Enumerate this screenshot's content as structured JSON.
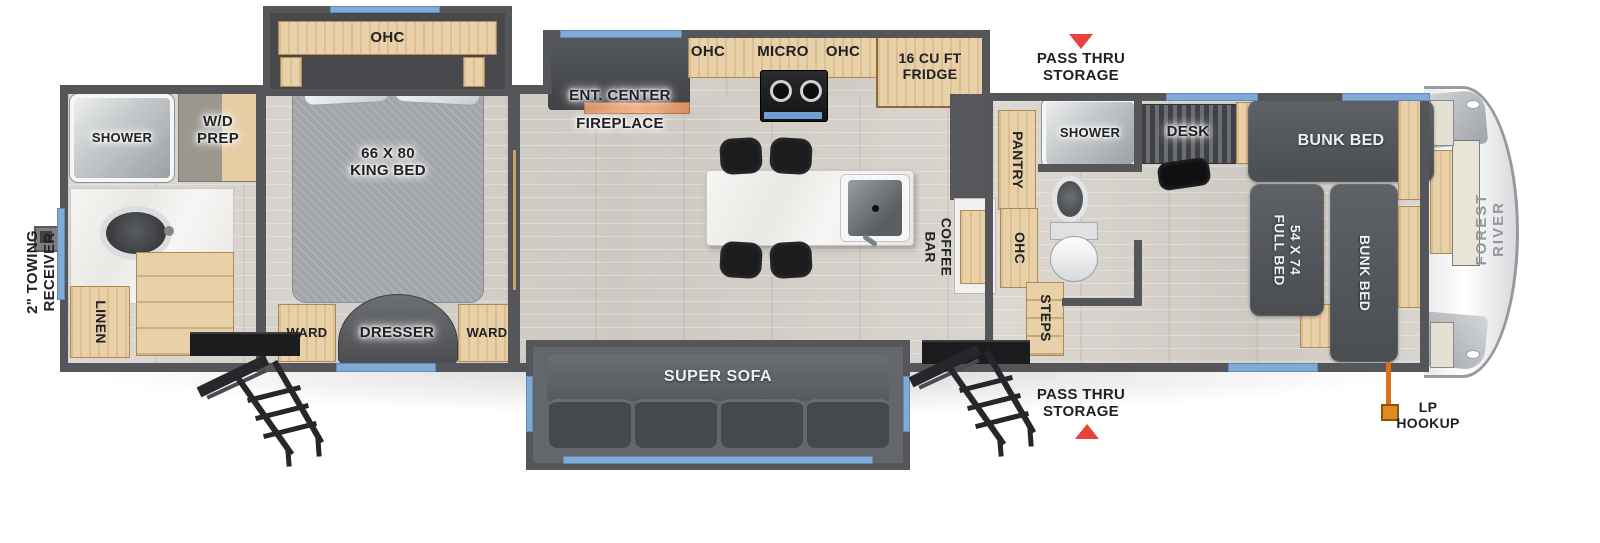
{
  "exterior": {
    "towing_receiver": "2\" TOWING\nRECEIVER",
    "pass_thru_storage_top": "PASS THRU\nSTORAGE",
    "pass_thru_storage_bottom": "PASS THRU\nSTORAGE",
    "lp_hookup": "LP\nHOOKUP",
    "brand": "FOREST RIVER"
  },
  "rear_bath": {
    "shower": "SHOWER",
    "wd_prep": "W/D\nPREP",
    "linen": "LINEN"
  },
  "bedroom": {
    "ohc": "OHC",
    "king_bed": "66 X 80\nKING BED",
    "ward_left": "WARD",
    "dresser": "DRESSER",
    "ward_right": "WARD"
  },
  "kitchen": {
    "ent_center": "ENT. CENTER",
    "fireplace": "FIREPLACE",
    "ohc_left": "OHC",
    "micro": "MICRO",
    "ohc_right": "OHC",
    "fridge": "16 CU FT\nFRIDGE",
    "coffee_bar": "COFFEE\nBAR"
  },
  "living": {
    "super_sofa": "SUPER SOFA"
  },
  "mid_bath": {
    "pantry": "PANTRY",
    "shower": "SHOWER",
    "ohc": "OHC",
    "steps": "STEPS"
  },
  "bunk_room": {
    "desk": "DESK",
    "bunk_bed_top": "BUNK BED",
    "full_bed": "54 X 74\nFULL BED",
    "bunk_bed_right": "BUNK BED"
  },
  "colors": {
    "wall": "#55565a",
    "wood": "#e8d0a8",
    "window_blue": "#7fabd6",
    "furniture_dark": "#4d5054",
    "arrow_red": "#e8423c",
    "lp_orange": "#e5861f"
  }
}
